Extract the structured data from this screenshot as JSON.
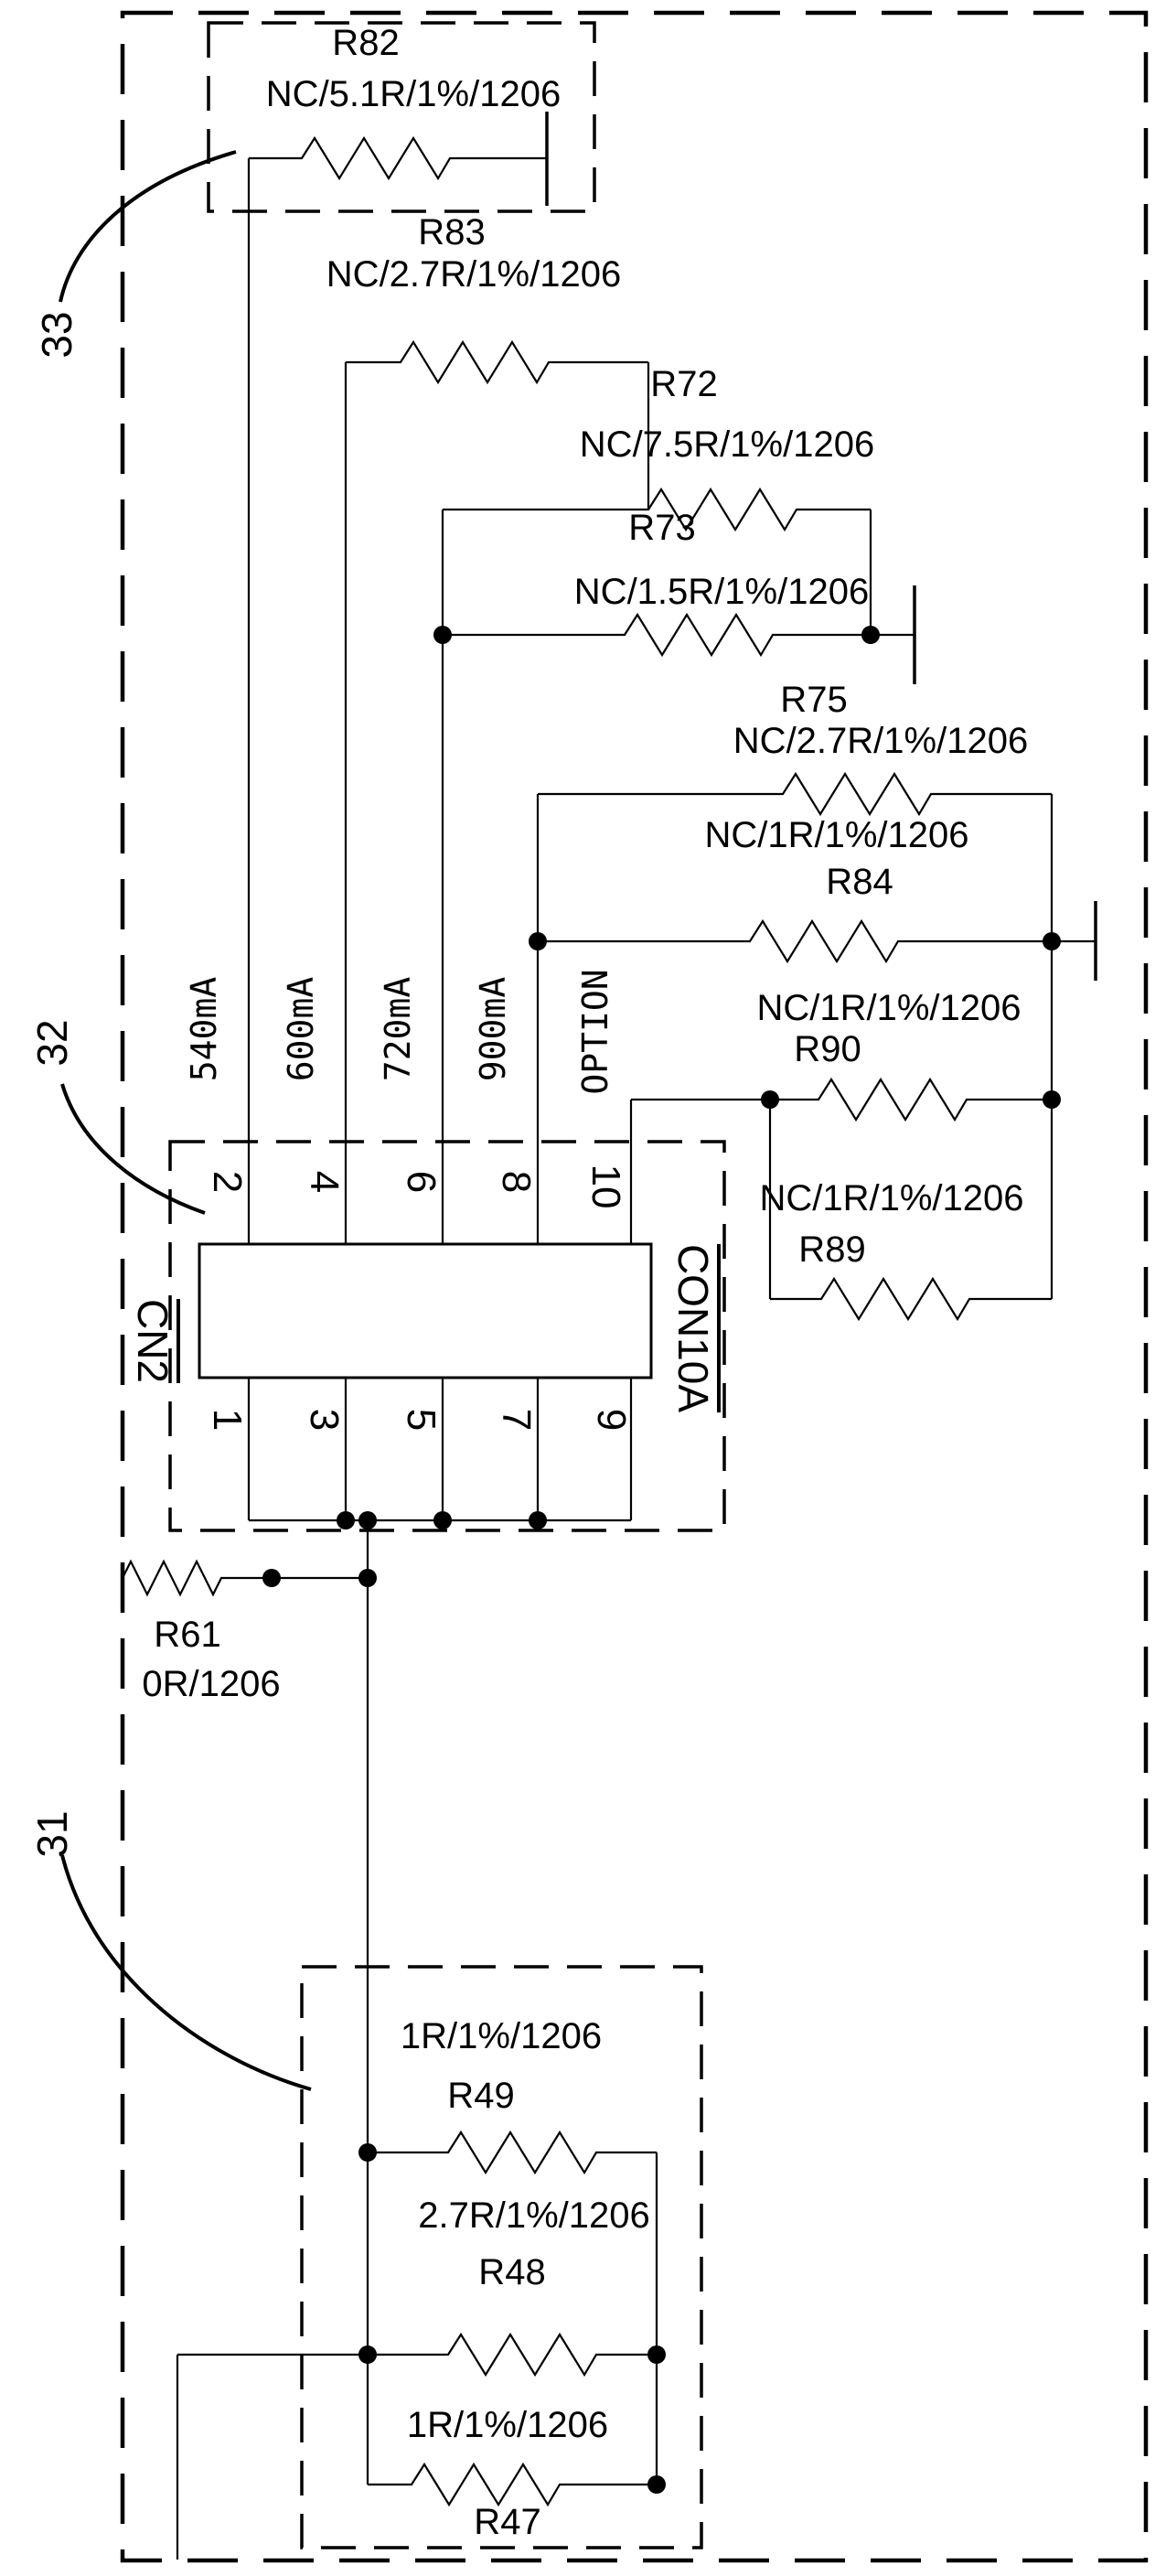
{
  "diagram": {
    "background": "#ffffff",
    "line_color": "#000000",
    "groups": {
      "g33": {
        "label": "33"
      },
      "g32": {
        "label": "32"
      },
      "g31": {
        "label": "31"
      }
    },
    "resistors": {
      "r82": {
        "designator": "R82",
        "value": "NC/5.1R/1%/1206"
      },
      "r83": {
        "designator": "R83",
        "value": "NC/2.7R/1%/1206"
      },
      "r72": {
        "designator": "R72",
        "value": "NC/7.5R/1%/1206"
      },
      "r73": {
        "designator": "R73",
        "value": "NC/1.5R/1%/1206"
      },
      "r75": {
        "designator": "R75",
        "value": "NC/2.7R/1%/1206"
      },
      "r84": {
        "designator": "R84",
        "value": "NC/1R/1%/1206"
      },
      "r90": {
        "designator": "R90",
        "value": "NC/1R/1%/1206"
      },
      "r89": {
        "designator": "R89",
        "value": "NC/1R/1%/1206"
      },
      "r61": {
        "designator": "R61",
        "value": "0R/1206"
      },
      "r49": {
        "designator": "R49",
        "value": "1R/1%/1206"
      },
      "r48": {
        "designator": "R48",
        "value": "2.7R/1%/1206"
      },
      "r47": {
        "designator": "R47",
        "value": "1R/1%/1206"
      }
    },
    "connector": {
      "refdes": "CN2",
      "part": "CON10A",
      "top_pins": [
        "2",
        "4",
        "6",
        "8",
        "10"
      ],
      "bottom_pins": [
        "1",
        "3",
        "5",
        "7",
        "9"
      ]
    },
    "signals": [
      "540mA",
      "600mA",
      "720mA",
      "900mA",
      "OPTION"
    ]
  }
}
